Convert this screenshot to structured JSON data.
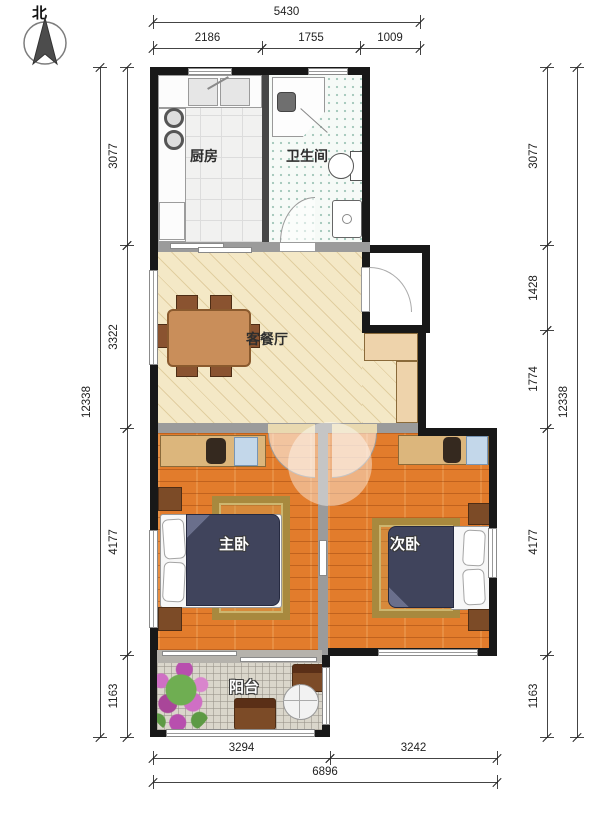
{
  "compass": {
    "north_label": "北"
  },
  "rooms": [
    {
      "id": "kitchen",
      "label": "厨房"
    },
    {
      "id": "bathroom",
      "label": "卫生间"
    },
    {
      "id": "living_dining",
      "label": "客餐厅"
    },
    {
      "id": "master_bedroom",
      "label": "主卧"
    },
    {
      "id": "second_bedroom",
      "label": "次卧"
    },
    {
      "id": "balcony",
      "label": "阳台"
    }
  ],
  "dimensions": {
    "top_total": {
      "orient": "h",
      "a1": 153,
      "a2": 420,
      "c": 22,
      "label": "5430"
    },
    "top_segments": [
      {
        "orient": "h",
        "a1": 153,
        "a2": 262,
        "c": 48,
        "label": "2186"
      },
      {
        "orient": "h",
        "a1": 262,
        "a2": 360,
        "c": 48,
        "label": "1755"
      },
      {
        "orient": "h",
        "a1": 360,
        "a2": 420,
        "c": 48,
        "label": "1009"
      }
    ],
    "left_total": {
      "orient": "v",
      "a1": 67,
      "a2": 737,
      "c": 100,
      "label": "12338"
    },
    "left_segments": [
      {
        "orient": "v",
        "a1": 67,
        "a2": 245,
        "c": 127,
        "label": "3077"
      },
      {
        "orient": "v",
        "a1": 245,
        "a2": 428,
        "c": 127,
        "label": "3322"
      },
      {
        "orient": "v",
        "a1": 428,
        "a2": 655,
        "c": 127,
        "label": "4177"
      },
      {
        "orient": "v",
        "a1": 655,
        "a2": 737,
        "c": 127,
        "label": "1163"
      }
    ],
    "right_total": {
      "orient": "v",
      "a1": 67,
      "a2": 737,
      "c": 577,
      "label": "12338"
    },
    "right_segments": [
      {
        "orient": "v",
        "a1": 67,
        "a2": 245,
        "c": 547,
        "label": "3077"
      },
      {
        "orient": "v",
        "a1": 245,
        "a2": 330,
        "c": 547,
        "label": "1428"
      },
      {
        "orient": "v",
        "a1": 330,
        "a2": 428,
        "c": 547,
        "label": "1774"
      },
      {
        "orient": "v",
        "a1": 428,
        "a2": 655,
        "c": 547,
        "label": "4177"
      },
      {
        "orient": "v",
        "a1": 655,
        "a2": 737,
        "c": 547,
        "label": "1163"
      }
    ],
    "bottom_segments": [
      {
        "orient": "h",
        "a1": 153,
        "a2": 330,
        "c": 758,
        "label": "3294"
      },
      {
        "orient": "h",
        "a1": 330,
        "a2": 497,
        "c": 758,
        "label": "3242"
      }
    ],
    "bottom_total": {
      "orient": "h",
      "a1": 153,
      "a2": 497,
      "c": 782,
      "label": "6896"
    }
  },
  "colors": {
    "outer_wall": "#181818",
    "interior_wall": "#9b9b9b",
    "living_floor": "#f4e8c6",
    "bedroom_floor": "#e27c2c",
    "balcony_floor": "#dad6cb",
    "bath_dot": "#a9cbbf",
    "cabinet_wood": "#dcb67c",
    "bed": "#40445c",
    "dim_text": "#222222"
  }
}
